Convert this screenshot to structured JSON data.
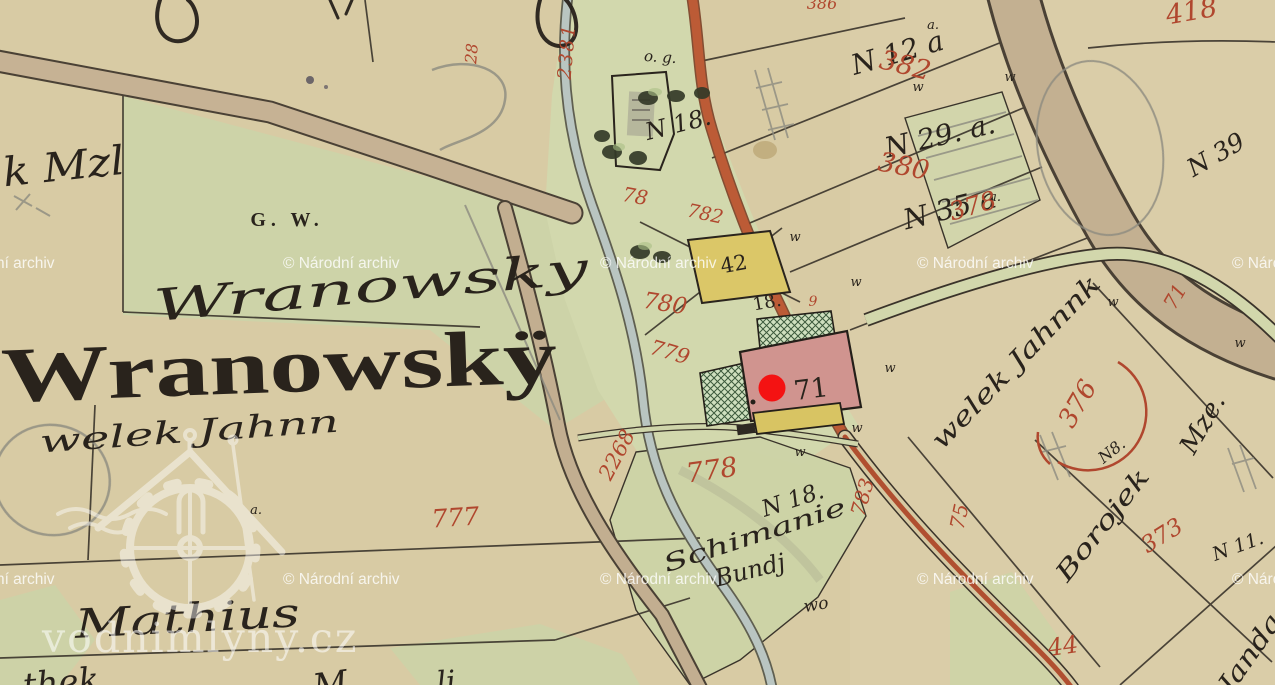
{
  "watermarks": {
    "archive_text": "© Národní archiv",
    "site_text": "vodnimlyny.cz",
    "rows": [
      {
        "y": 268,
        "xs": [
          -62,
          283,
          600,
          917,
          1232
        ]
      },
      {
        "y": 584,
        "xs": [
          -62,
          283,
          600,
          917,
          1232
        ]
      }
    ]
  },
  "marker": {
    "x": 772,
    "y": 388,
    "r": 13.5,
    "color": "#f41212"
  },
  "colors": {
    "parchment": "#d8cba4",
    "field_green": "#cdd3a8",
    "village_green": "#d2d8ad",
    "road_tan": "#c4b093",
    "road_red": "#bc5b36",
    "stream": "#b9c5c1",
    "building_pink": "#d0948f",
    "building_yellow": "#dbc768",
    "red_ink": "#b0472e",
    "black_ink": "#29231c",
    "pencil": "#8d8b80"
  },
  "labels": {
    "ink": [
      {
        "t": "Wranowskÿ",
        "x": 280,
        "y": 392,
        "r": -2,
        "s": 78,
        "p": 1,
        "tl": 556,
        "n": "place-name-print"
      },
      {
        "t": "Wranowsky",
        "x": 372,
        "y": 302,
        "r": -5,
        "s": 44,
        "tl": 436,
        "n": "place-name-script"
      },
      {
        "t": "G. W.",
        "x": 287,
        "y": 226,
        "r": 0,
        "s": 20,
        "p": 1,
        "ls": 5,
        "n": "label-g-w"
      },
      {
        "t": "welek Jahnn",
        "x": 190,
        "y": 442,
        "r": -4,
        "s": 31,
        "tl": 300
      },
      {
        "t": "k Mzl",
        "x": 65,
        "y": 180,
        "r": -6,
        "s": 40,
        "tl": 122
      },
      {
        "t": "Mathius",
        "x": 188,
        "y": 632,
        "r": -3,
        "s": 40,
        "tl": 225
      },
      {
        "t": "thek",
        "x": 62,
        "y": 694,
        "r": -5,
        "s": 34
      },
      {
        "t": "M",
        "x": 332,
        "y": 696,
        "r": -8,
        "s": 34
      },
      {
        "t": "li",
        "x": 447,
        "y": 692,
        "r": -5,
        "s": 30
      },
      {
        "t": "o. g.",
        "x": 660,
        "y": 62,
        "r": 4,
        "s": 15
      },
      {
        "t": "N 18.",
        "x": 680,
        "y": 132,
        "r": -14,
        "s": 24
      },
      {
        "t": "N 12 a",
        "x": 900,
        "y": 62,
        "r": -16,
        "s": 28
      },
      {
        "t": "N 29. a.",
        "x": 942,
        "y": 145,
        "r": -13,
        "s": 28
      },
      {
        "t": "N 35 a",
        "x": 952,
        "y": 218,
        "r": -14,
        "s": 28
      },
      {
        "t": "N 39",
        "x": 1220,
        "y": 162,
        "r": -30,
        "s": 25
      },
      {
        "t": "42",
        "x": 735,
        "y": 271,
        "r": -10,
        "s": 21,
        "u": 1
      },
      {
        "t": "18.",
        "x": 768,
        "y": 308,
        "r": -10,
        "s": 18,
        "u": 1
      },
      {
        "t": "71",
        "x": 812,
        "y": 398,
        "r": -7,
        "s": 27,
        "u": 1,
        "n": "house-number-71"
      },
      {
        "t": "N 18.",
        "x": 795,
        "y": 507,
        "r": -18,
        "s": 23
      },
      {
        "t": "Schimanie",
        "x": 757,
        "y": 543,
        "r": -18,
        "s": 24,
        "tl": 190
      },
      {
        "t": "Bundj",
        "x": 752,
        "y": 578,
        "r": -14,
        "s": 24
      },
      {
        "t": "wo",
        "x": 817,
        "y": 610,
        "r": -10,
        "s": 17
      },
      {
        "t": "welek Jahnnk",
        "x": 1022,
        "y": 368,
        "r": -46,
        "s": 26,
        "tl": 230
      },
      {
        "t": "Mze.",
        "x": 1210,
        "y": 428,
        "r": -60,
        "s": 26
      },
      {
        "t": "N8.",
        "x": 1115,
        "y": 455,
        "r": -38,
        "s": 16
      },
      {
        "t": "Borojek",
        "x": 1109,
        "y": 530,
        "r": -52,
        "s": 25,
        "tl": 135
      },
      {
        "t": "N 11.",
        "x": 1240,
        "y": 552,
        "r": -20,
        "s": 19
      },
      {
        "t": "Janda",
        "x": 1257,
        "y": 658,
        "r": -55,
        "s": 26,
        "tl": 90
      },
      {
        "t": "w",
        "x": 795,
        "y": 241,
        "s": 13
      },
      {
        "t": "w",
        "x": 856,
        "y": 286,
        "s": 13
      },
      {
        "t": "w",
        "x": 890,
        "y": 372,
        "s": 13
      },
      {
        "t": "w",
        "x": 857,
        "y": 432,
        "s": 13
      },
      {
        "t": "w",
        "x": 800,
        "y": 456,
        "s": 13
      },
      {
        "t": "w",
        "x": 918,
        "y": 91,
        "s": 13
      },
      {
        "t": "w",
        "x": 1010,
        "y": 81,
        "s": 13
      },
      {
        "t": "w",
        "x": 1240,
        "y": 347,
        "s": 13
      },
      {
        "t": "w",
        "x": 1113,
        "y": 306,
        "s": 13
      },
      {
        "t": "a.",
        "x": 933,
        "y": 29,
        "s": 13
      },
      {
        "t": "a.",
        "x": 995,
        "y": 201,
        "s": 13
      },
      {
        "t": "a.",
        "x": 256,
        "y": 514,
        "s": 13
      }
    ],
    "red": [
      {
        "t": "2381",
        "x": 573,
        "y": 52,
        "r": -85,
        "s": 19,
        "ls": 2
      },
      {
        "t": "28",
        "x": 477,
        "y": 54,
        "r": -85,
        "s": 16
      },
      {
        "t": "418",
        "x": 1193,
        "y": 20,
        "r": -10,
        "s": 27
      },
      {
        "t": "386",
        "x": 822,
        "y": 9,
        "s": 16
      },
      {
        "t": "382",
        "x": 903,
        "y": 74,
        "r": 14,
        "s": 27
      },
      {
        "t": "380",
        "x": 902,
        "y": 175,
        "r": 11,
        "s": 27
      },
      {
        "t": "378",
        "x": 975,
        "y": 214,
        "r": -16,
        "s": 25
      },
      {
        "t": "376",
        "x": 1085,
        "y": 408,
        "r": -60,
        "s": 26
      },
      {
        "t": "373",
        "x": 1166,
        "y": 542,
        "r": -32,
        "s": 23
      },
      {
        "t": "71",
        "x": 1181,
        "y": 300,
        "r": -60,
        "s": 20
      },
      {
        "t": "75",
        "x": 966,
        "y": 518,
        "r": -78,
        "s": 20
      },
      {
        "t": "783",
        "x": 869,
        "y": 499,
        "r": -74,
        "s": 20
      },
      {
        "t": "44",
        "x": 1064,
        "y": 654,
        "r": -8,
        "s": 24
      },
      {
        "t": "2268",
        "x": 623,
        "y": 458,
        "r": -62,
        "s": 21
      },
      {
        "t": "78",
        "x": 634,
        "y": 203,
        "r": 10,
        "s": 20
      },
      {
        "t": "782",
        "x": 704,
        "y": 220,
        "r": 12,
        "s": 19
      },
      {
        "t": "780",
        "x": 664,
        "y": 311,
        "r": 9,
        "s": 23
      },
      {
        "t": "779",
        "x": 668,
        "y": 359,
        "r": 16,
        "s": 21
      },
      {
        "t": "777",
        "x": 456,
        "y": 526,
        "r": -4,
        "s": 25
      },
      {
        "t": "778",
        "x": 713,
        "y": 479,
        "r": -8,
        "s": 27
      },
      {
        "t": "9",
        "x": 813,
        "y": 306,
        "s": 14
      }
    ]
  }
}
